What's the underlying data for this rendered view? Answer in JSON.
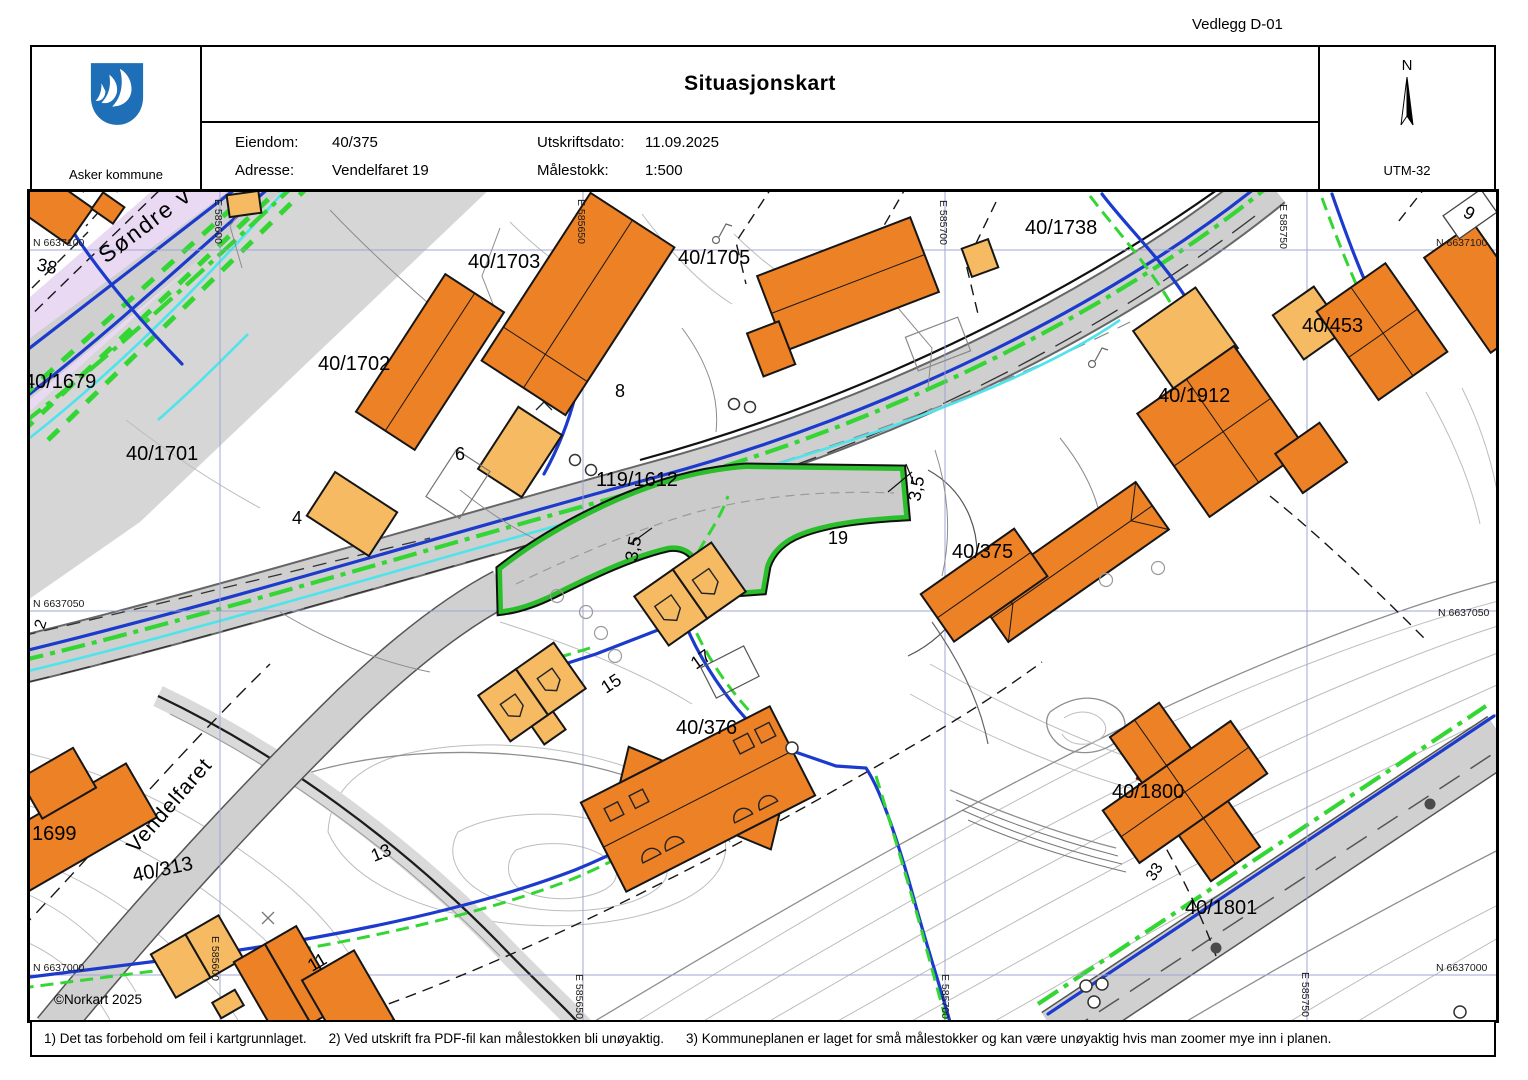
{
  "page": {
    "attachment_label": "Vedlegg D-01"
  },
  "header": {
    "logo_text": "Asker kommune",
    "title": "Situasjonskart",
    "fields": [
      {
        "label": "Eiendom:",
        "value": "40/375"
      },
      {
        "label": "Adresse:",
        "value": "Vendelfaret 19"
      },
      {
        "label": "Utskriftsdato:",
        "value": "11.09.2025"
      },
      {
        "label": "Målestokk:",
        "value": "1:500"
      }
    ],
    "compass": {
      "north_label": "N",
      "utm_label": "UTM-32"
    }
  },
  "map": {
    "colors": {
      "building_dark": "#EC8126",
      "building_light": "#F6BB62",
      "road_gray": "#CFCFCF",
      "highlight_green": "#2ABE2B",
      "utility_blue": "#1C3BCC",
      "utility_green": "#33D633",
      "water_cyan": "#4FE3EC",
      "zone_lavender": "#E9D9F2",
      "grid_blue": "#99A0CE"
    },
    "grid": {
      "n1": "N 6637100",
      "n2": "N 6637050",
      "n3": "N 6637000",
      "e1": "E 585600",
      "e2": "E 585650",
      "e3": "E 585700",
      "e4": "E 585750"
    },
    "labels": {
      "sondre": "Søndre v",
      "vendelfaret": "Vendelfaret",
      "p1679": "40/1679",
      "p1701": "40/1701",
      "p1702": "40/1702",
      "p1703": "40/1703",
      "p1705": "40/1705",
      "p1738": "40/1738",
      "p453": "40/453",
      "p1912": "40/1912",
      "p119": "119/1612",
      "p375": "40/375",
      "p376": "40/376",
      "p1800": "40/1800",
      "p1801": "40/1801",
      "p313": "40/313",
      "p1699": "1699",
      "n38": "38",
      "n9": "9",
      "n8": "8",
      "n6": "6",
      "n4": "4",
      "n2": "2",
      "n19": "19",
      "n17": "17",
      "n15": "15",
      "n13": "13",
      "n11": "11",
      "n33": "33",
      "m35": "3,5",
      "copyright": "©Norkart 2025"
    }
  },
  "footer": {
    "notes": [
      "1) Det tas forbehold om feil i kartgrunnlaget.",
      "2) Ved utskrift fra PDF-fil kan målestokken bli unøyaktig.",
      "3) Kommuneplanen er laget for små målestokker og kan være unøyaktig hvis man zoomer mye inn i planen."
    ]
  }
}
